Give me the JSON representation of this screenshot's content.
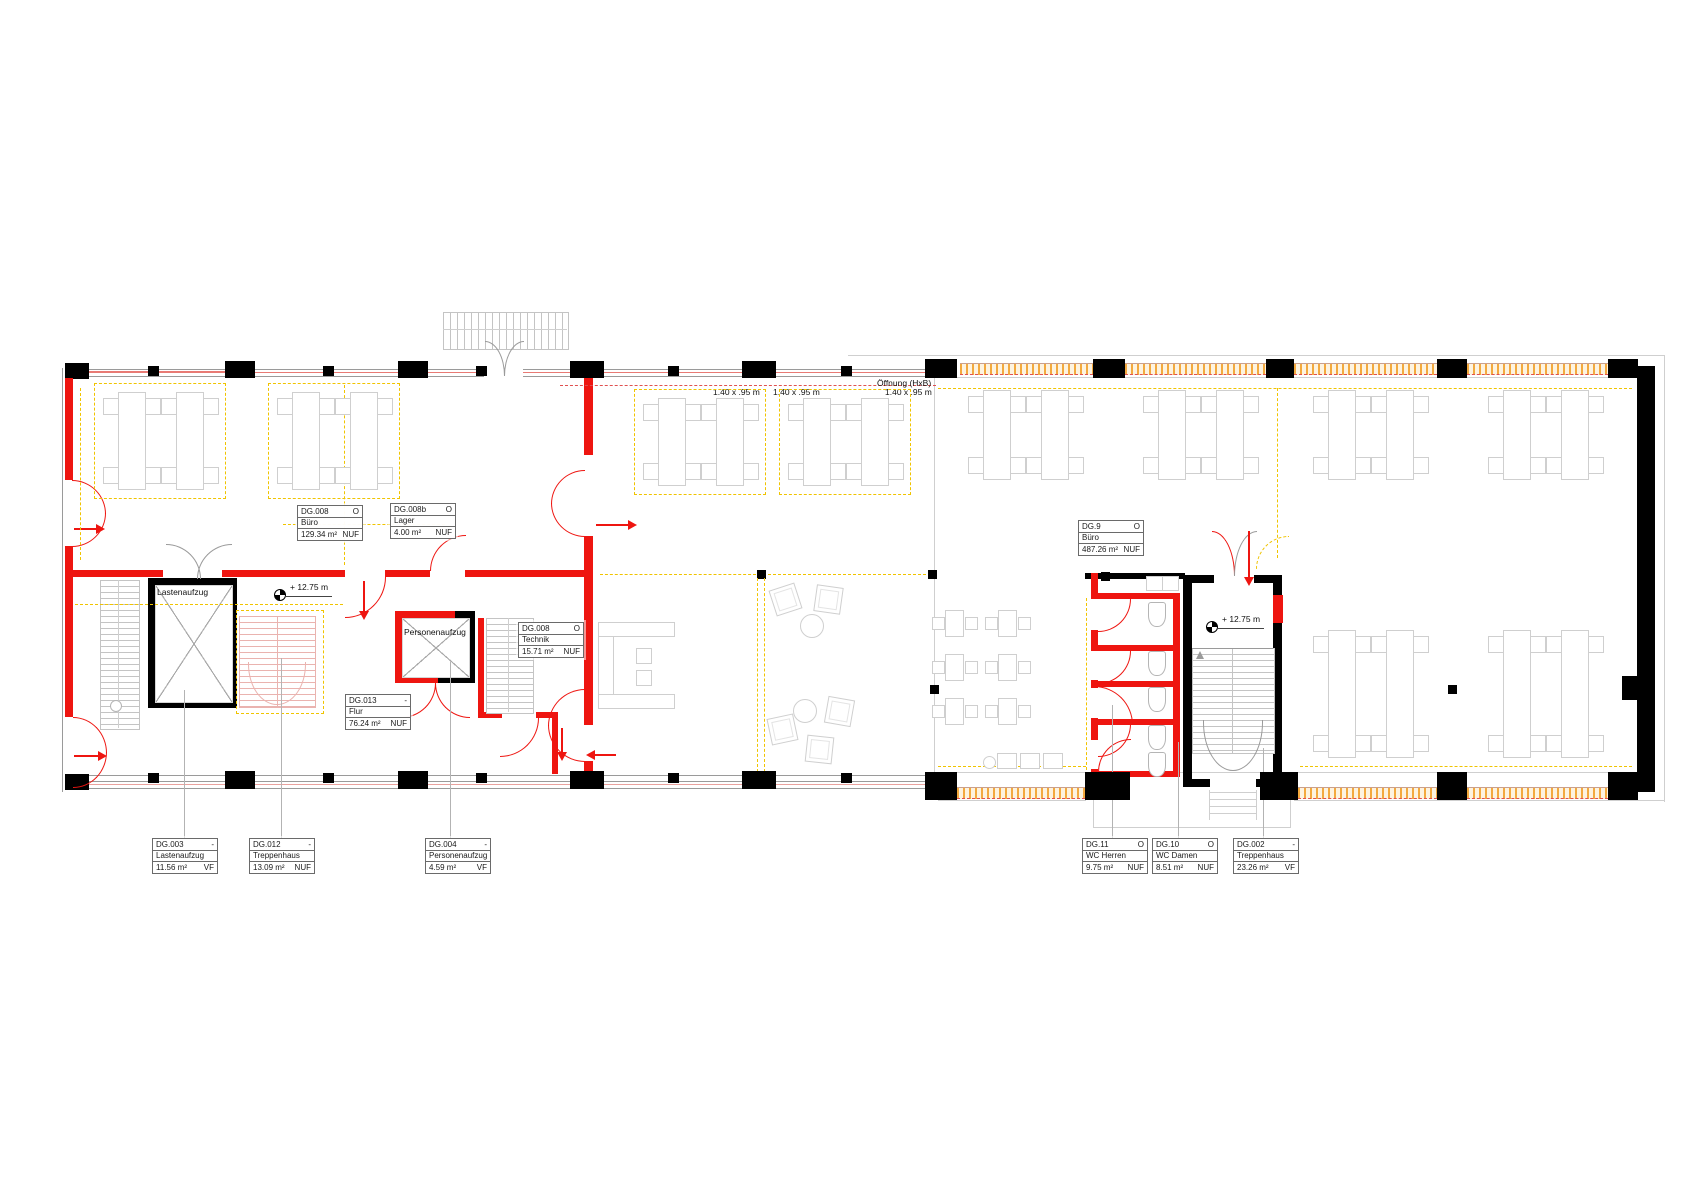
{
  "annotations": {
    "window_dims": [
      "1.40 x .95 m",
      "1.40 x .95 m",
      "1.40 x .95 m"
    ],
    "opening_label": "Öffnung (HxB)",
    "level_mark": "+ 12.75 m"
  },
  "inline_rooms": {
    "freight_elevator": "Lastenaufzug",
    "passenger_elevator": "Personenaufzug"
  },
  "room_tags": {
    "dg008": {
      "id": "DG.008",
      "flag": "O",
      "name": "Büro",
      "area": "129.34 m²",
      "unit": "NUF"
    },
    "dg008b": {
      "id": "DG.008b",
      "flag": "O",
      "name": "Lager",
      "area": "4.00 m²",
      "unit": "NUF"
    },
    "dg9": {
      "id": "DG.9",
      "flag": "O",
      "name": "Büro",
      "area": "487.26 m²",
      "unit": "NUF"
    },
    "dg008t": {
      "id": "DG.008",
      "flag": "O",
      "name": "Technik",
      "area": "15.71 m²",
      "unit": "NUF"
    },
    "dg013": {
      "id": "DG.013",
      "flag": "-",
      "name": "Flur",
      "area": "76.24 m²",
      "unit": "NUF"
    },
    "dg003": {
      "id": "DG.003",
      "flag": "-",
      "name": "Lastenaufzug",
      "area": "11.56 m²",
      "unit": "VF"
    },
    "dg012": {
      "id": "DG.012",
      "flag": "-",
      "name": "Treppenhaus",
      "area": "13.09 m²",
      "unit": "NUF"
    },
    "dg004": {
      "id": "DG.004",
      "flag": "-",
      "name": "Personenaufzug",
      "area": "4.59 m²",
      "unit": "VF"
    },
    "dg11": {
      "id": "DG.11",
      "flag": "O",
      "name": "WC Herren",
      "area": "9.75 m²",
      "unit": "NUF"
    },
    "dg10": {
      "id": "DG.10",
      "flag": "O",
      "name": "WC Damen",
      "area": "8.51 m²",
      "unit": "NUF"
    },
    "dg002": {
      "id": "DG.002",
      "flag": "-",
      "name": "Treppenhaus",
      "area": "23.26 m²",
      "unit": "VF"
    }
  },
  "colors": {
    "wall_black": "#000000",
    "highlight_red": "#ee1510",
    "escape_route_yellow": "#f0c400",
    "window_band_orange": "#f3a93e",
    "stair_pink": "#eab3af",
    "furniture_gray": "#cfcfcf"
  }
}
